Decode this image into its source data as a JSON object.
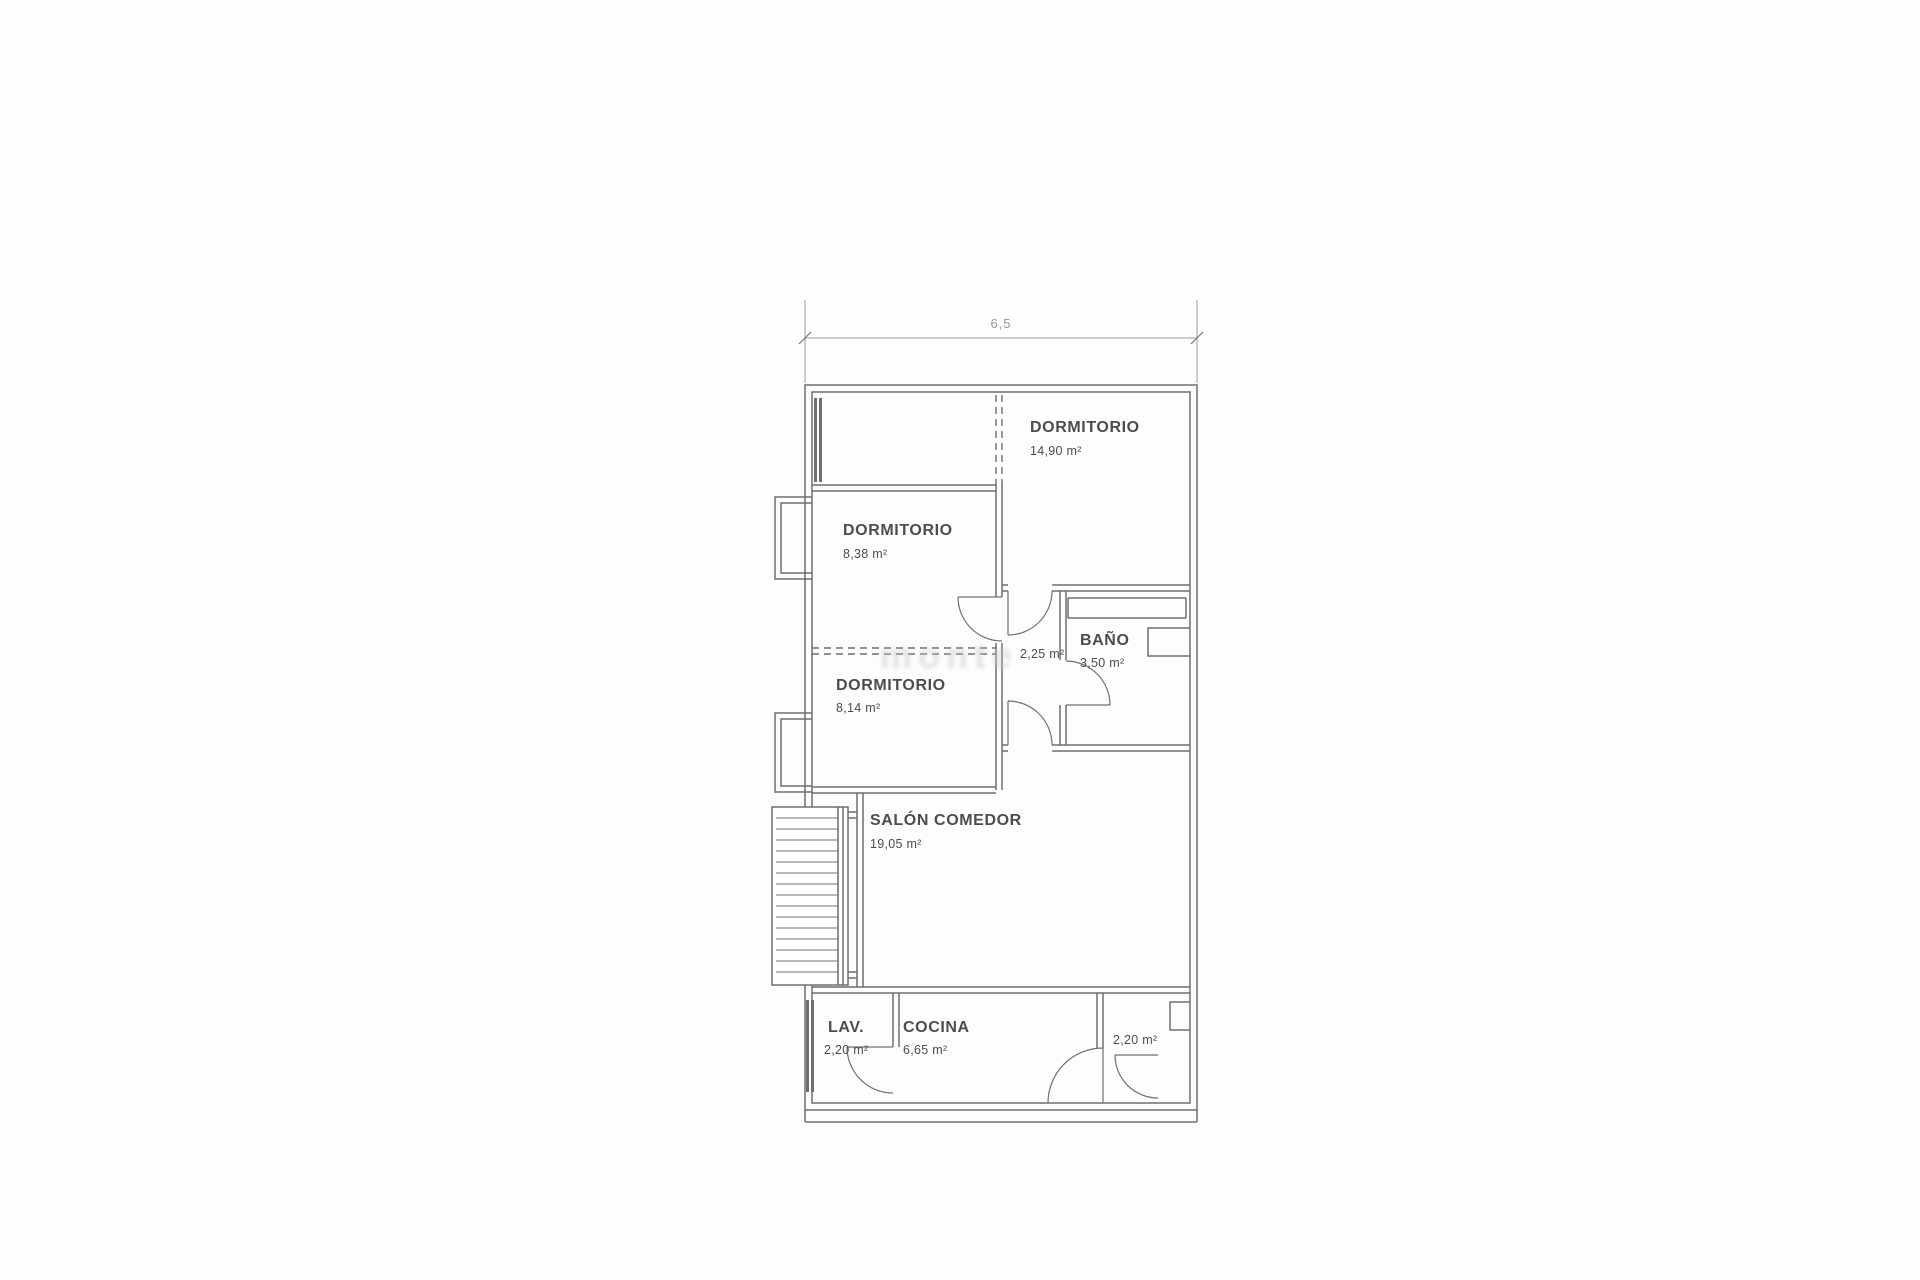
{
  "plan": {
    "dimensions": {
      "width_label": "6,5"
    },
    "watermark": "monte",
    "rooms": [
      {
        "name": "DORMITORIO",
        "area": "14,90 m²"
      },
      {
        "name": "DORMITORIO",
        "area": "8,38 m²"
      },
      {
        "name": "DORMITORIO",
        "area": "8,14 m²"
      },
      {
        "name": "BAÑO",
        "area": "3,50 m²"
      },
      {
        "name": "",
        "area": "2,25 m²"
      },
      {
        "name": "SALÓN COMEDOR",
        "area": "19,05 m²"
      },
      {
        "name": "LAV.",
        "area": "2,20 m²"
      },
      {
        "name": "COCINA",
        "area": "6,65 m²"
      },
      {
        "name": "",
        "area": "2,20 m²"
      }
    ],
    "colors": {
      "line": "#6f6f6f",
      "text": "#4c4c4c",
      "dim": "#9a9a9a",
      "watermark": "#c6c6c6",
      "paper": "#fdfdfd"
    }
  }
}
